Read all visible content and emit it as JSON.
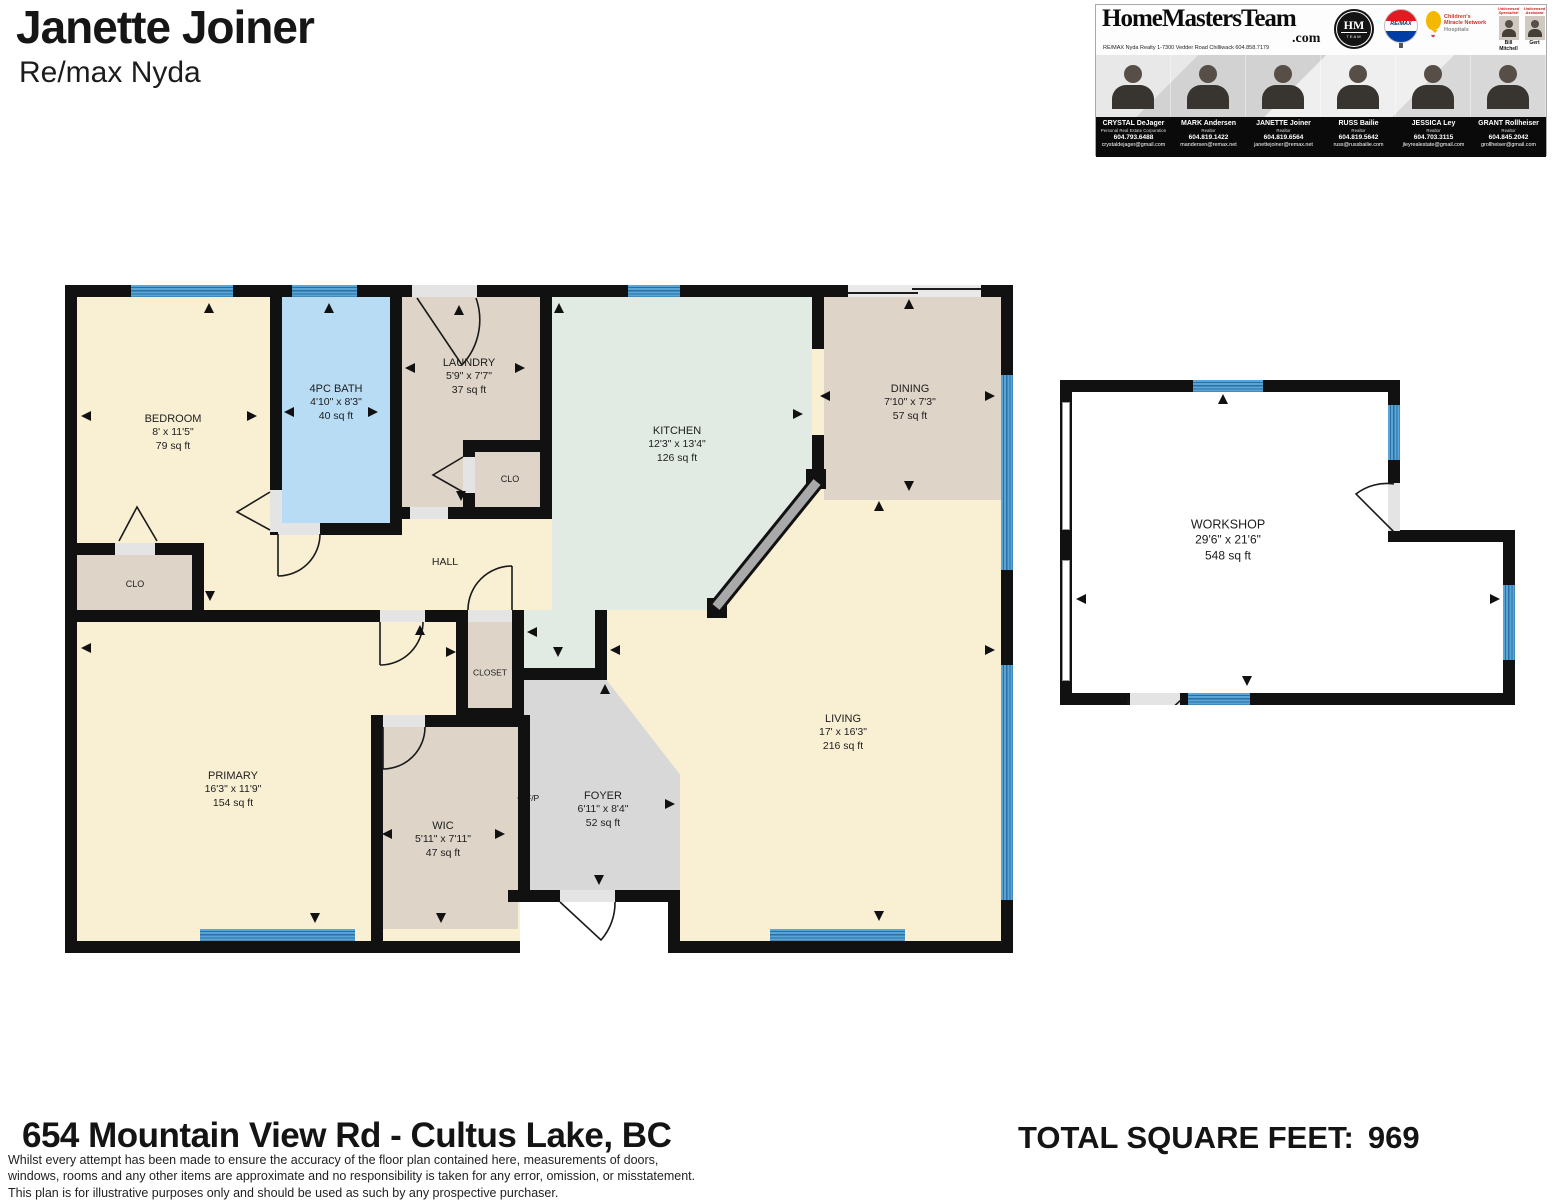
{
  "header": {
    "name": "Janette Joiner",
    "brokerage": "Re/max Nyda"
  },
  "banner": {
    "brand": "HomeMastersTeam",
    "tld": ".com",
    "office_line": "RE/MAX Nyda Realty   1-7300 Vedder Road   Chilliwack 604.858.7179",
    "hm_logo_top": "HM",
    "hm_logo_bottom": "TEAM",
    "remax_label": "RE/MAX",
    "cmn_line1": "Children's",
    "cmn_line2": "Miracle Network",
    "cmn_line3": "Hospitals",
    "badges": [
      {
        "tag": "Unlicensed Specialist!",
        "name": "Bill Mitchell"
      },
      {
        "tag": "Unlicensed Assistant",
        "name": "Gert"
      }
    ],
    "agents": [
      {
        "name": "CRYSTAL DeJager",
        "title": "Personal Real Estate Corporation",
        "phone": "604.793.6488",
        "email": "crystaldejager@gmail.com"
      },
      {
        "name": "MARK Andersen",
        "title": "Realtor",
        "phone": "604.819.1422",
        "email": "mandersen@remax.net"
      },
      {
        "name": "JANETTE Joiner",
        "title": "Realtor",
        "phone": "604.819.6564",
        "email": "janettejoiner@remax.net"
      },
      {
        "name": "RUSS Bailie",
        "title": "Realtor",
        "phone": "604.819.5642",
        "email": "russ@russbailie.com"
      },
      {
        "name": "JESSICA Ley",
        "title": "Realtor",
        "phone": "604.703.3115",
        "email": "jleyrealestate@gmail.com"
      },
      {
        "name": "GRANT Rollheiser",
        "title": "Realtor",
        "phone": "604.845.2042",
        "email": "grollheiser@gmail.com"
      }
    ]
  },
  "plan": {
    "fp_label": "F/P",
    "rooms": [
      {
        "name": "BEDROOM",
        "dims": "8' x 11'5\"",
        "area": "79 sq ft"
      },
      {
        "name": "4PC BATH",
        "dims": "4'10\" x 8'3\"",
        "area": "40 sq ft"
      },
      {
        "name": "LAUNDRY",
        "dims": "5'9\" x 7'7\"",
        "area": "37 sq ft"
      },
      {
        "name": "CLO"
      },
      {
        "name": "KITCHEN",
        "dims": "12'3\" x 13'4\"",
        "area": "126 sq ft"
      },
      {
        "name": "DINING",
        "dims": "7'10\" x 7'3\"",
        "area": "57 sq ft"
      },
      {
        "name": "HALL"
      },
      {
        "name": "CLO"
      },
      {
        "name": "PRIMARY",
        "dims": "16'3\" x 11'9\"",
        "area": "154 sq ft"
      },
      {
        "name": "CLOSET"
      },
      {
        "name": "WIC",
        "dims": "5'11\" x 7'11\"",
        "area": "47 sq ft"
      },
      {
        "name": "FOYER",
        "dims": "6'11\" x 8'4\"",
        "area": "52 sq ft"
      },
      {
        "name": "LIVING",
        "dims": "17' x 16'3\"",
        "area": "216 sq ft"
      },
      {
        "name": "WORKSHOP",
        "dims": "29'6\" x 21'6\"",
        "area": "548 sq ft"
      }
    ],
    "colors": {
      "cream": "#f9f0d4",
      "bath_blue": "#b8dcf4",
      "tan": "#ded4c8",
      "mint": "#e1eae3",
      "foyer_gray": "#d8d8d8",
      "window_blue": "#4e9fd4",
      "wall": "#111111"
    }
  },
  "footer": {
    "address": "654 Mountain View Rd -  Cultus Lake, BC",
    "total_label": "TOTAL SQUARE FEET:",
    "total_value": "969",
    "disclaimer": [
      "Whilst every attempt has been made to ensure the accuracy of the floor plan contained here, measurements of doors,",
      "windows, rooms and any other items are approximate and no responsibility is taken for any error, omission, or misstatement.",
      "This plan is for illustrative purposes only and should be used as such by any prospective purchaser."
    ]
  }
}
